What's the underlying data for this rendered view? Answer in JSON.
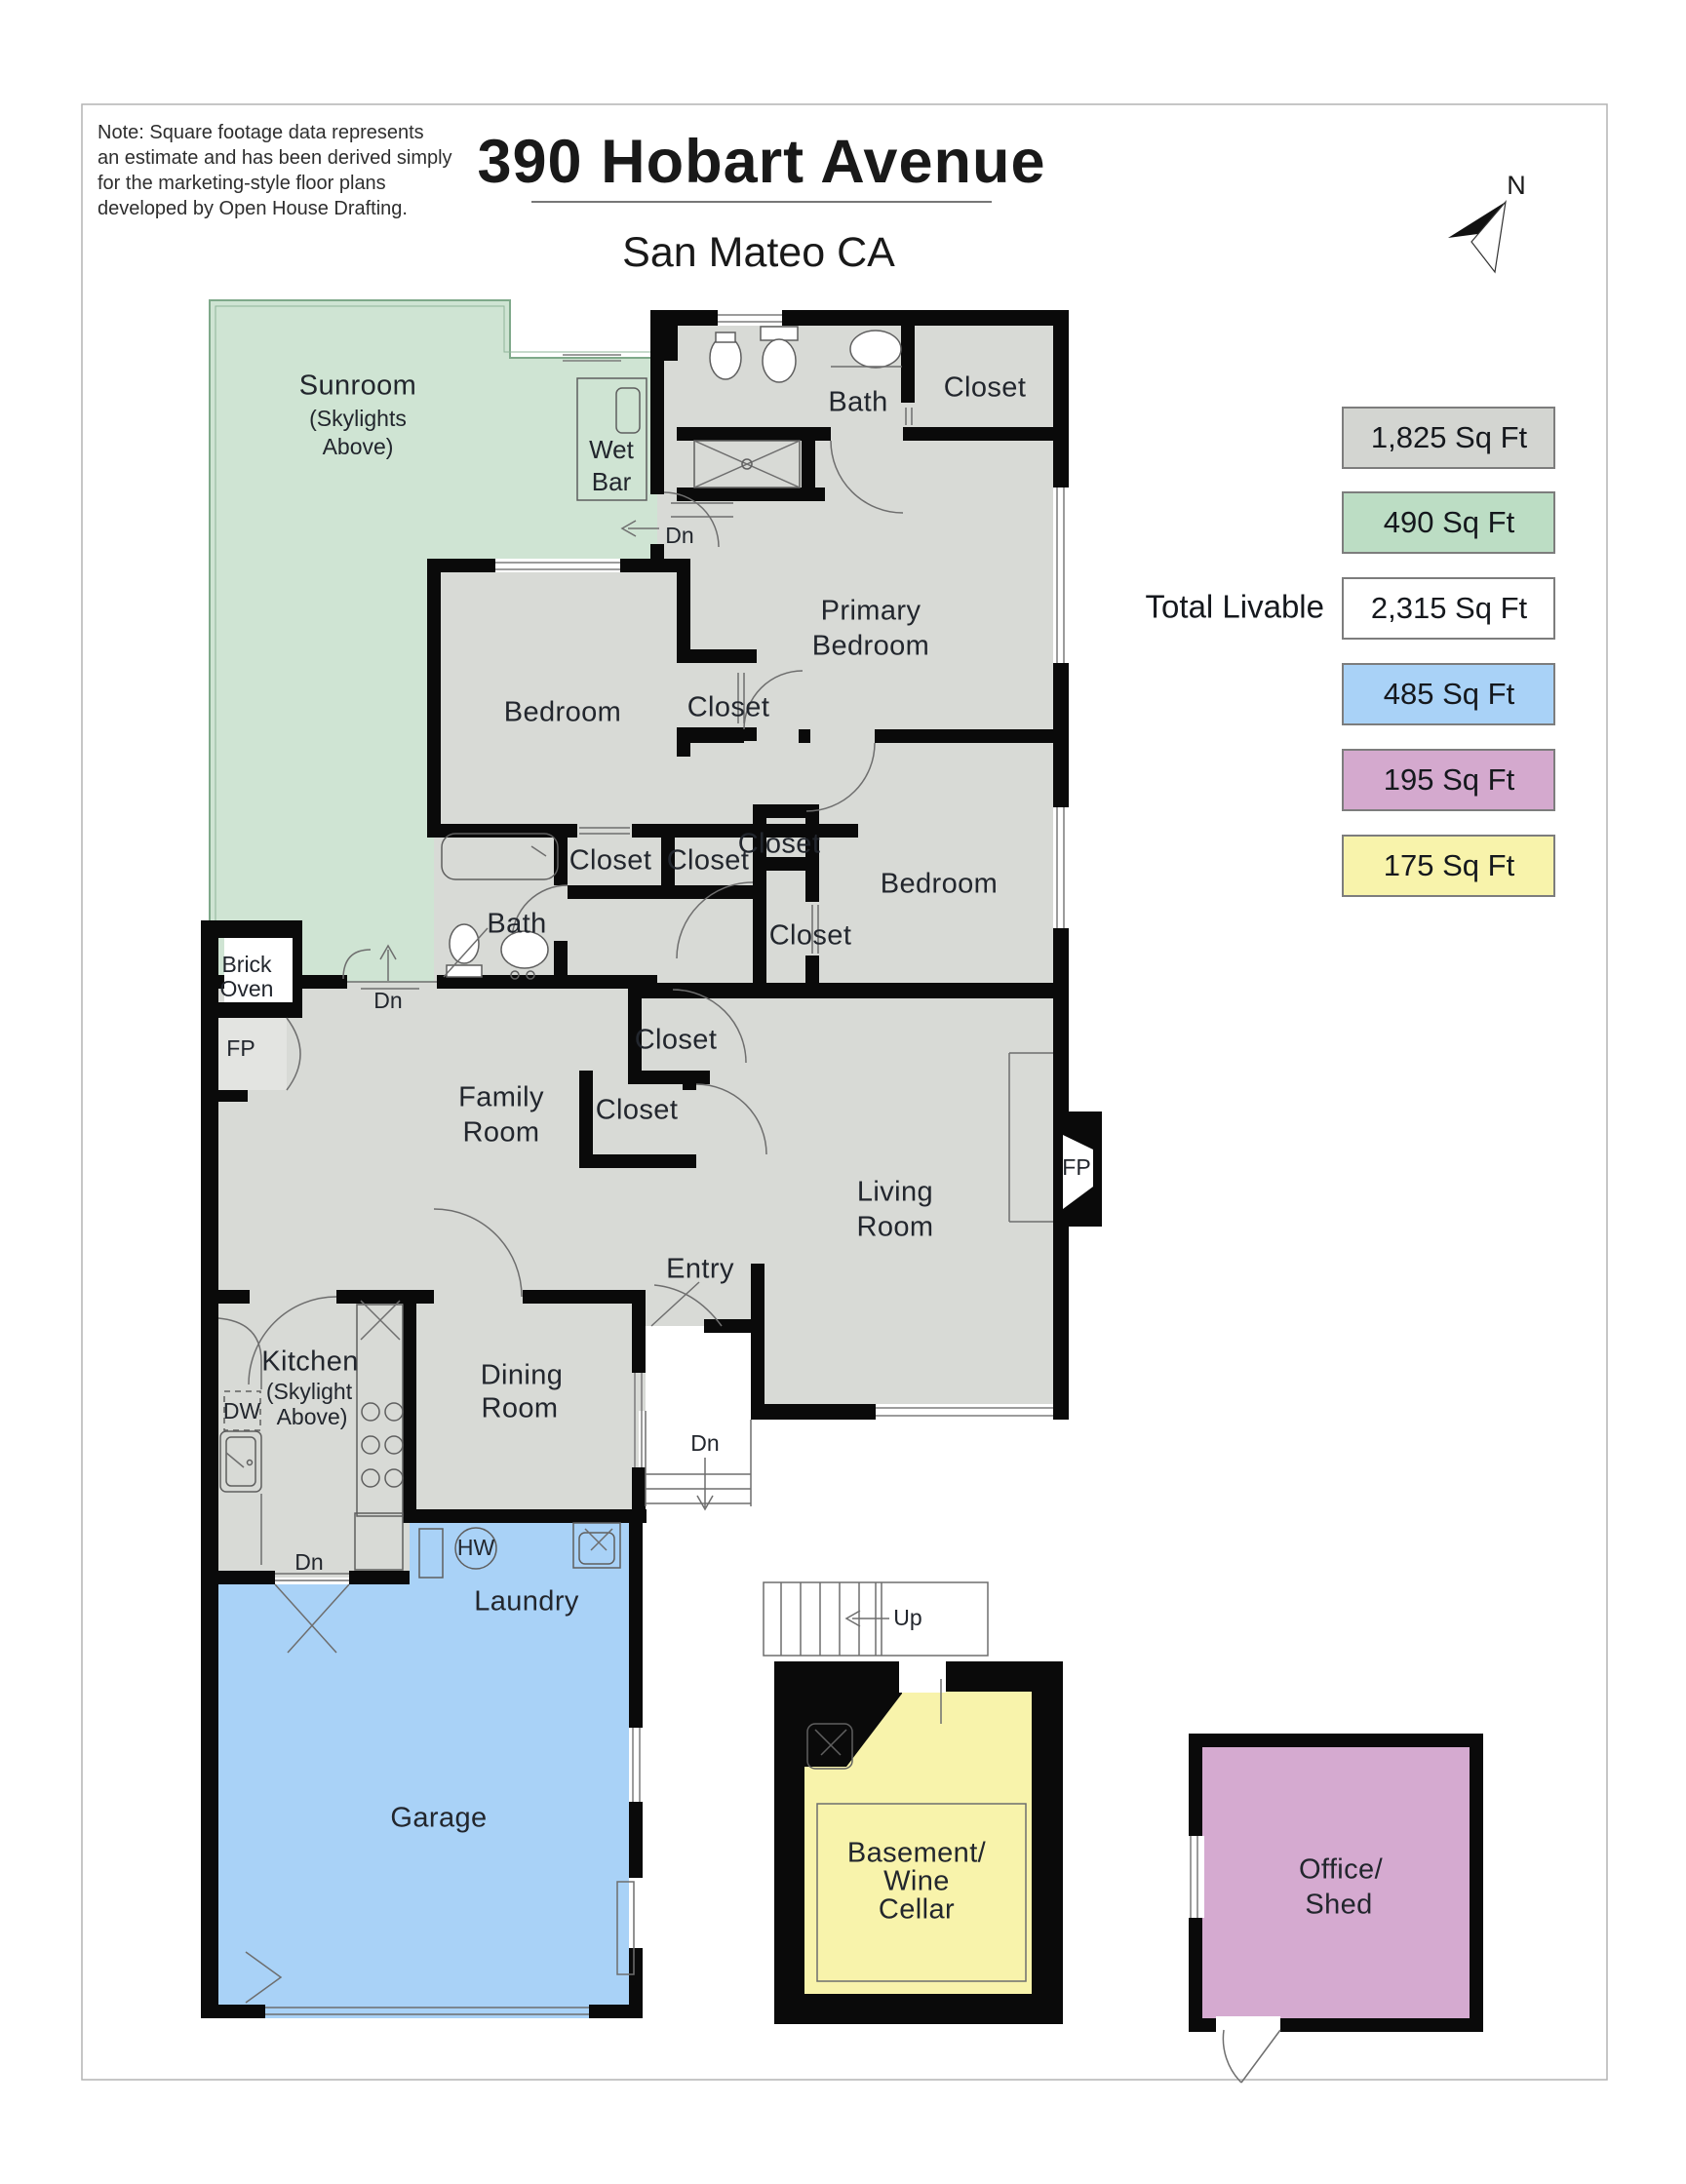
{
  "header": {
    "note": [
      "Note: Square footage data represents",
      "an estimate and has been derived simply",
      "for the marketing-style floor plans",
      "developed by Open House Drafting."
    ],
    "title": "390 Hobart Avenue",
    "subtitle": "San Mateo CA",
    "compass": "N"
  },
  "legend": {
    "total_label": "Total Livable",
    "items": [
      {
        "id": "main-house",
        "value": "1,825 Sq Ft",
        "color": "#d3d5d1"
      },
      {
        "id": "sunroom",
        "value": "490 Sq Ft",
        "color": "#bcddc4"
      },
      {
        "id": "total-livable",
        "value": "2,315 Sq Ft",
        "color": "#ffffff"
      },
      {
        "id": "garage-laundry",
        "value": "485 Sq Ft",
        "color": "#a9d2f7"
      },
      {
        "id": "office-shed",
        "value": "195 Sq Ft",
        "color": "#d4a9ce"
      },
      {
        "id": "basement",
        "value": "175 Sq Ft",
        "color": "#f8f3ab"
      }
    ]
  },
  "colors": {
    "main": "#d8dad6",
    "sunroom": "#cfe4d3",
    "garage": "#a9d2f7",
    "basement": "#f8f3ab",
    "office": "#d5aad0",
    "wall": "#0a0a0a"
  },
  "labels": {
    "closet": "Closet",
    "bath": "Bath",
    "bedroom": "Bedroom",
    "fp": "FP",
    "dn": "Dn",
    "up": "Up",
    "dw": "DW",
    "hw": "HW",
    "entry": "Entry",
    "laundry": "Laundry",
    "garage": "Garage",
    "sunroom": [
      "Sunroom",
      "(Skylights",
      "Above)"
    ],
    "wet_bar": [
      "Wet",
      "Bar"
    ],
    "primary": [
      "Primary",
      "Bedroom"
    ],
    "family": [
      "Family",
      "Room"
    ],
    "living": [
      "Living",
      "Room"
    ],
    "dining": [
      "Dining",
      "Room"
    ],
    "kitchen": [
      "Kitchen",
      "(Skylight",
      "Above)"
    ],
    "brick_oven": [
      "Brick",
      "Oven"
    ],
    "basement": [
      "Basement/",
      "Wine",
      "Cellar"
    ],
    "office": [
      "Office/",
      "Shed"
    ]
  }
}
